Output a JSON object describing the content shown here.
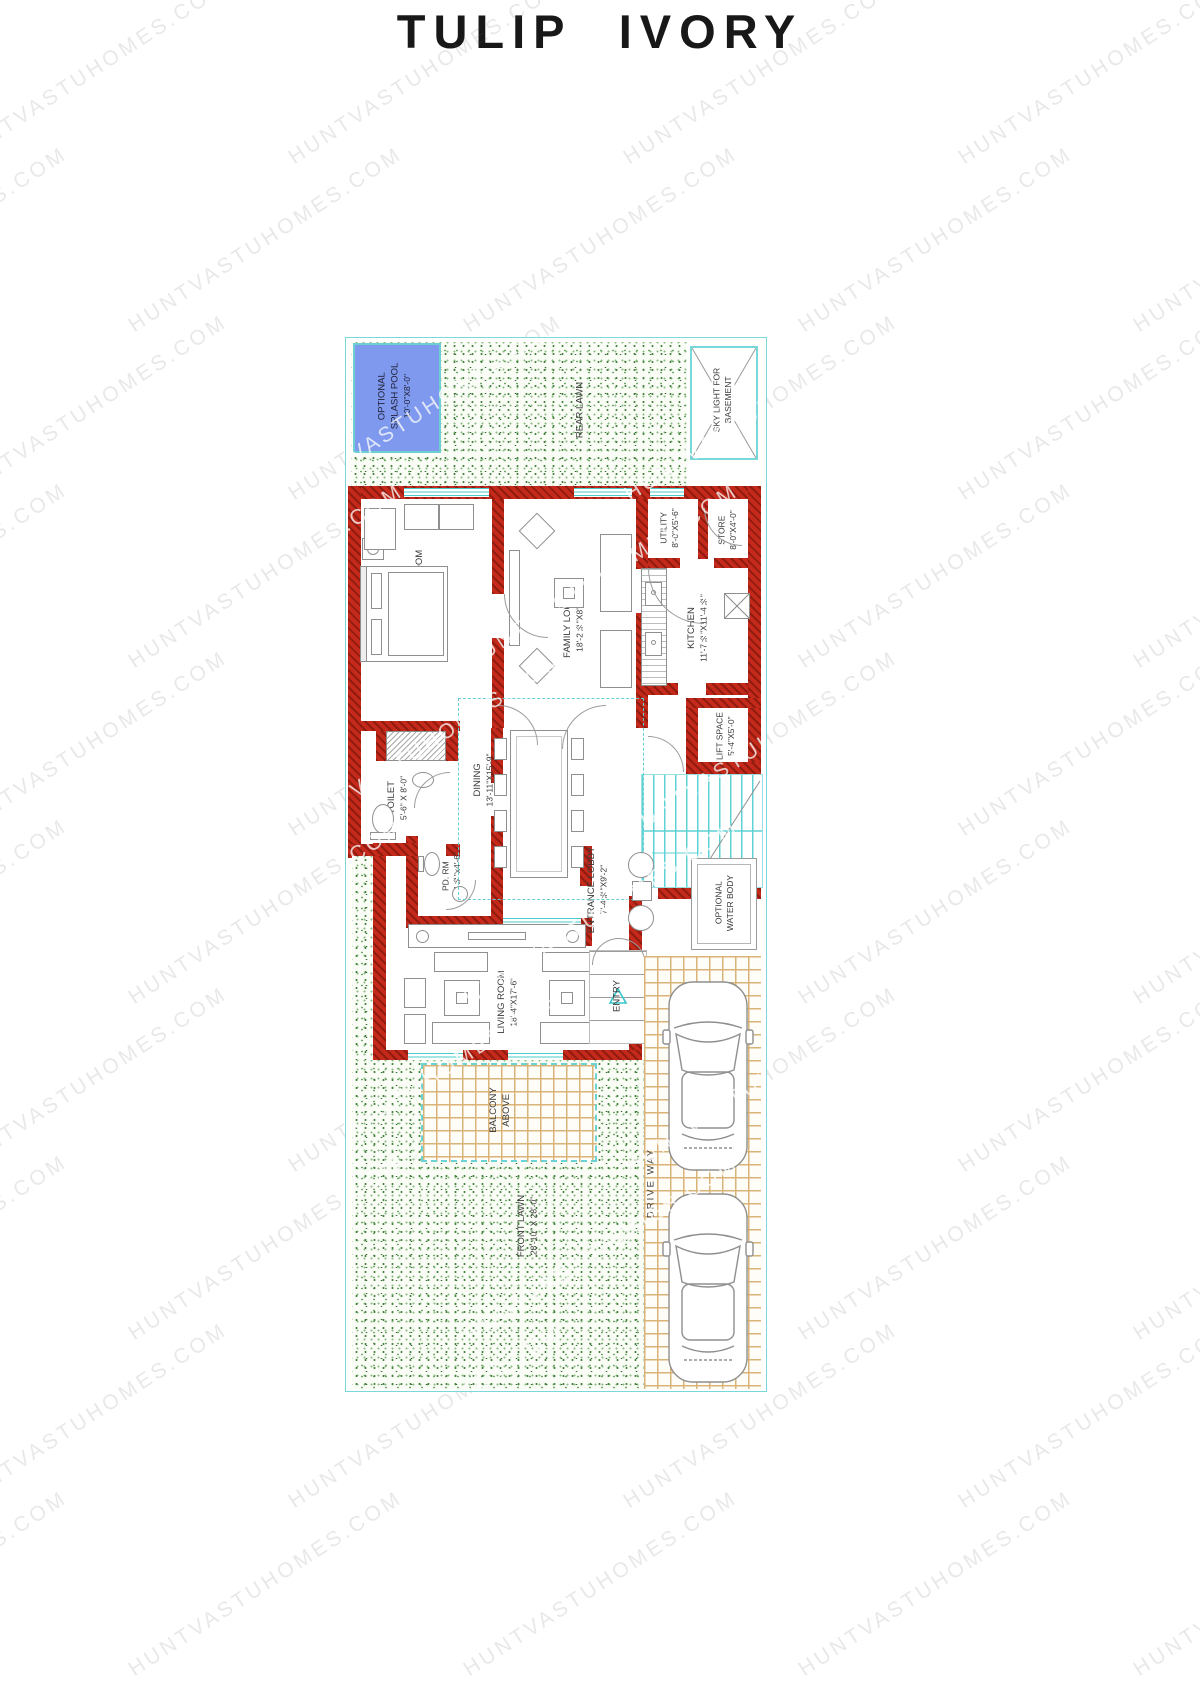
{
  "title": "TULIP IVORY",
  "watermark": "HUNTVASTUHOMES.COM",
  "colors": {
    "wall": "#c5291b",
    "boundary": "#78d8da",
    "pool": "#7e99ed",
    "tile_line": "#d9b478",
    "lawn_dot": "#46823f",
    "label": "#3a3a3a"
  },
  "rooms": {
    "rear_lawn": {
      "name": "REAR LAWN"
    },
    "splash_pool": {
      "line1": "OPTIONAL",
      "line2": "SPLASH POOL",
      "dims": "10'-0\"X8'-0\""
    },
    "skylight": {
      "line1": "SKY LIGHT FOR",
      "line2": "BASEMENT"
    },
    "parents_bed": {
      "name": "PARENT'S BED ROOM",
      "dims": "19'-0\"X12'-10\""
    },
    "family_lounge": {
      "name": "FAMILY LOUNGE",
      "dims": "18'-2½\"X8'-5½\""
    },
    "utility": {
      "name": "UTILITY",
      "dims": "8'-0\"X5'-6\""
    },
    "store": {
      "name": "STORE",
      "dims": "8'-0\"X4'-0\""
    },
    "kitchen": {
      "name": "KITCHEN",
      "dims": "11'-7½\"X11'-4½\""
    },
    "lift": {
      "name": "LIFT SPACE",
      "dims": "5'-4\"X5'-0\""
    },
    "stairs": {
      "dn": "DN",
      "up": "UP"
    },
    "toilet": {
      "name": "TOILET",
      "dims": "5'-6\" X 8'-0\""
    },
    "cupboard": {
      "name": "C.B."
    },
    "dining": {
      "name": "DINING",
      "dims": "13'-11\"X15'-9\"",
      "note": "DOUBLE HEIGHT"
    },
    "powder": {
      "name": "PD. RM",
      "dims": "7'-4½\"x4'-6\""
    },
    "entrance_lobby": {
      "name": "ENTRANCE LOBBY",
      "dims": "7'-4½\"X9'-2\""
    },
    "water_body": {
      "line1": "OPTIONAL",
      "line2": "WATER BODY"
    },
    "living": {
      "name": "LIVING ROOM",
      "dims": "18'-4\"X17'-6\""
    },
    "entry": {
      "name": "ENTRY"
    },
    "balcony": {
      "line1": "BALCONY",
      "line2": "ABOVE"
    },
    "front_lawn": {
      "name": "FRONT LAWN",
      "dims": "28'-10\" X 28'-0\""
    },
    "driveway": {
      "name": "DRIVE WAY"
    }
  }
}
